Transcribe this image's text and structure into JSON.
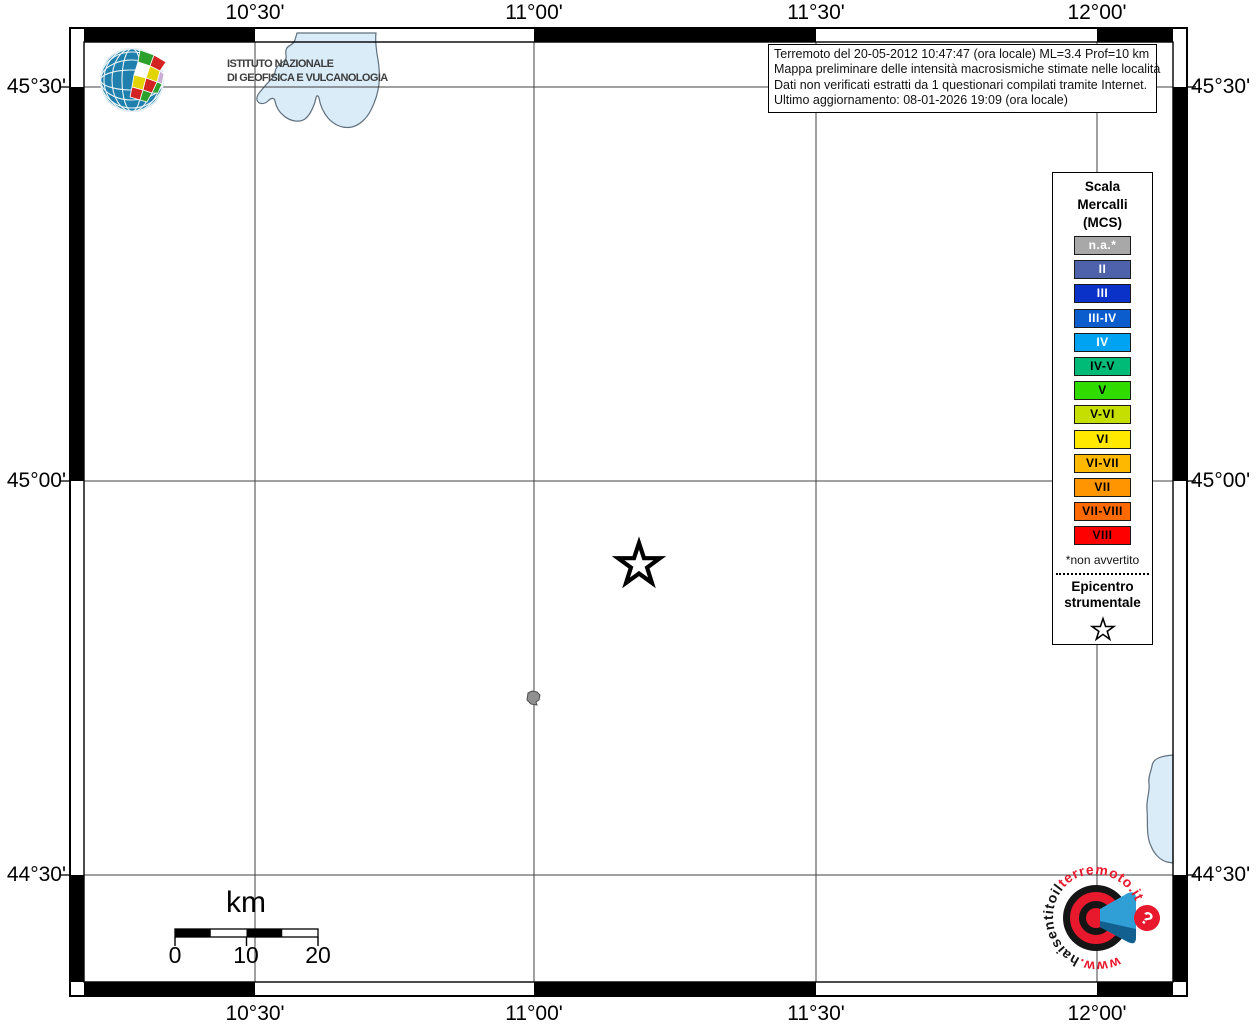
{
  "header": {
    "ingv_line1": "ISTITUTO NAZIONALE",
    "ingv_line2": "DI GEOFISICA E VULCANOLOGIA"
  },
  "info_box": {
    "line1": "Terremoto del 20-05-2012 10:47:47 (ora locale) ML=3.4 Prof=10 km",
    "line2": "Mappa preliminare delle intensità macrosismiche stimate nelle località",
    "line3": "Dati non verificati estratti da 1 questionari compilati tramite Internet.",
    "line4": "Ultimo aggiornamento: 08-01-2026 19:09 (ora locale)"
  },
  "axes": {
    "top": [
      "10°30'",
      "11°00'",
      "11°30'",
      "12°00'"
    ],
    "bottom": [
      "10°30'",
      "11°00'",
      "11°30'",
      "12°00'"
    ],
    "left": [
      "45°30'",
      "45°00'",
      "44°30'"
    ],
    "right": [
      "45°30'",
      "45°00'",
      "44°30'"
    ]
  },
  "legend": {
    "title_lines": [
      "Scala",
      "Mercalli",
      "(MCS)"
    ],
    "items": [
      {
        "label": "n.a.*",
        "color": "#a8a8a8",
        "text_color": "#ffffff"
      },
      {
        "label": "II",
        "color": "#4d62ab",
        "text_color": "#ffffff"
      },
      {
        "label": "III",
        "color": "#0a32c8",
        "text_color": "#ffffff"
      },
      {
        "label": "III-IV",
        "color": "#0b5ccc",
        "text_color": "#ffffff"
      },
      {
        "label": "IV",
        "color": "#00a2f2",
        "text_color": "#ffffff"
      },
      {
        "label": "IV-V",
        "color": "#00ba78",
        "text_color": "#000000"
      },
      {
        "label": "V",
        "color": "#30dc00",
        "text_color": "#000000"
      },
      {
        "label": "V-VI",
        "color": "#c5e000",
        "text_color": "#000000"
      },
      {
        "label": "VI",
        "color": "#ffe900",
        "text_color": "#000000"
      },
      {
        "label": "VI-VII",
        "color": "#ffb800",
        "text_color": "#000000"
      },
      {
        "label": "VII",
        "color": "#ff9500",
        "text_color": "#000000"
      },
      {
        "label": "VII-VIII",
        "color": "#ff6a00",
        "text_color": "#000000"
      },
      {
        "label": "VIII",
        "color": "#ff0000",
        "text_color": "#000000"
      }
    ],
    "footnote": "*non avvertito",
    "epicenter_line1": "Epicentro",
    "epicenter_line2": "strumentale",
    "epicenter_icon": "star-icon"
  },
  "scale_bar": {
    "unit": "km",
    "tick_labels": [
      "0",
      "10",
      "20"
    ]
  },
  "map": {
    "epicenter_icon": "star-icon",
    "locality_icon": "gray-locality-marker",
    "water_icon": "lake-polygon"
  },
  "watermark": {
    "red_prefix": "www.",
    "black_mid": "haisentitoil",
    "red_suffix": "terremoto.it",
    "question_mark": "?"
  },
  "colors": {
    "lake_fill": "#d9ecf8",
    "lake_stroke": "#61707e",
    "grid": "#404040",
    "frame": "#000000",
    "ingv_globe_blue": "#1f7fad",
    "watermark_red": "#e8192c",
    "watermark_blue": "#2f9fd6"
  }
}
